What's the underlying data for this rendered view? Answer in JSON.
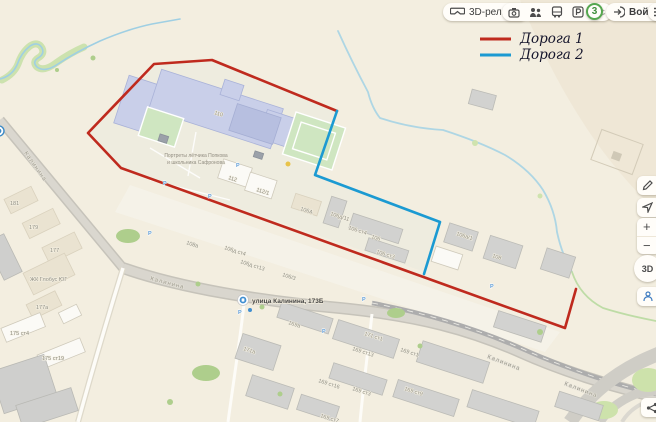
{
  "toolbar": {
    "terrain_label": "3D-рельеф",
    "traffic_score": "3",
    "login_label": "Войти",
    "icons": [
      "3d-glasses-icon",
      "attractions-camera-icon",
      "crowd-icon",
      "bus-icon",
      "parking-icon",
      "panoramas-icon",
      "login-arrow-icon",
      "menu-icon"
    ]
  },
  "legend": {
    "road1_label": "Дорога 1",
    "road2_label": "Дорога 2",
    "road1_color": "#bf2a1e",
    "road2_color": "#1b9ad2"
  },
  "controls": {
    "edit_icon": "ruler-pencil-icon",
    "locate_icon": "navigator-arrow-icon",
    "zoom_in": "+",
    "zoom_out": "−",
    "dial_label": "3D",
    "pano_icon": "panorama-camera-icon",
    "share_icon": "share-icon"
  },
  "map": {
    "bus_stop_label": "улица Калинина, 173Б",
    "poi_line1": "Портреты лётчика Попкова",
    "poi_line2": "и школьника Сафронова",
    "parking_symbol": "Р",
    "road_labels": [
      {
        "text": "Калинина",
        "x": 24,
        "y": 153,
        "rot": 55
      },
      {
        "text": "Калинина",
        "x": 150,
        "y": 280,
        "rot": 15
      },
      {
        "text": "Калинина",
        "x": 487,
        "y": 358,
        "rot": 21
      },
      {
        "text": "Калинина",
        "x": 564,
        "y": 385,
        "rot": 21
      }
    ],
    "building_labels": [
      {
        "text": "110",
        "x": 214,
        "y": 114,
        "rot": 18
      },
      {
        "text": "112",
        "x": 228,
        "y": 179,
        "rot": 18
      },
      {
        "text": "112/1",
        "x": 256,
        "y": 191,
        "rot": 18
      },
      {
        "text": "108а",
        "x": 186,
        "y": 244,
        "rot": 18
      },
      {
        "text": "106д ст4",
        "x": 224,
        "y": 249,
        "rot": 18
      },
      {
        "text": "106д ст13",
        "x": 240,
        "y": 263,
        "rot": 18
      },
      {
        "text": "106/3",
        "x": 282,
        "y": 276,
        "rot": 18
      },
      {
        "text": "106А",
        "x": 300,
        "y": 210,
        "rot": 18
      },
      {
        "text": "106д/11",
        "x": 330,
        "y": 215,
        "rot": 18
      },
      {
        "text": "106 ст4",
        "x": 348,
        "y": 229,
        "rot": 18
      },
      {
        "text": "106",
        "x": 371,
        "y": 238,
        "rot": 18
      },
      {
        "text": "106 ст3",
        "x": 376,
        "y": 253,
        "rot": 18
      },
      {
        "text": "106а/1",
        "x": 456,
        "y": 235,
        "rot": 18
      },
      {
        "text": "108",
        "x": 492,
        "y": 257,
        "rot": 18
      },
      {
        "text": "181",
        "x": 10,
        "y": 205,
        "rot": 0
      },
      {
        "text": "179",
        "x": 29,
        "y": 229,
        "rot": 0
      },
      {
        "text": "177",
        "x": 50,
        "y": 252,
        "rot": 0
      },
      {
        "text": "ЖК Глобус ЮГ",
        "x": 30,
        "y": 281,
        "rot": 0
      },
      {
        "text": "177а",
        "x": 36,
        "y": 309,
        "rot": 0
      },
      {
        "text": "175 ст4",
        "x": 10,
        "y": 335,
        "rot": 0
      },
      {
        "text": "175 ст19",
        "x": 42,
        "y": 360,
        "rot": 0
      },
      {
        "text": "169а",
        "x": 288,
        "y": 324,
        "rot": 18
      },
      {
        "text": "171а",
        "x": 243,
        "y": 350,
        "rot": 18
      },
      {
        "text": "171 ст1",
        "x": 364,
        "y": 335,
        "rot": 18
      },
      {
        "text": "169 ст13",
        "x": 352,
        "y": 350,
        "rot": 18
      },
      {
        "text": "169 ст1",
        "x": 400,
        "y": 351,
        "rot": 18
      },
      {
        "text": "169 ст16",
        "x": 318,
        "y": 382,
        "rot": 18
      },
      {
        "text": "169 ст3",
        "x": 352,
        "y": 390,
        "rot": 18
      },
      {
        "text": "169 ст9",
        "x": 404,
        "y": 390,
        "rot": 18
      },
      {
        "text": "169 ст7",
        "x": 320,
        "y": 417,
        "rot": 18
      }
    ],
    "parking_marks": [
      {
        "x": 163,
        "y": 185
      },
      {
        "x": 208,
        "y": 198
      },
      {
        "x": 148,
        "y": 235
      },
      {
        "x": 236,
        "y": 167
      },
      {
        "x": 238,
        "y": 314
      },
      {
        "x": 322,
        "y": 333
      },
      {
        "x": 362,
        "y": 301
      },
      {
        "x": 490,
        "y": 288
      }
    ]
  }
}
